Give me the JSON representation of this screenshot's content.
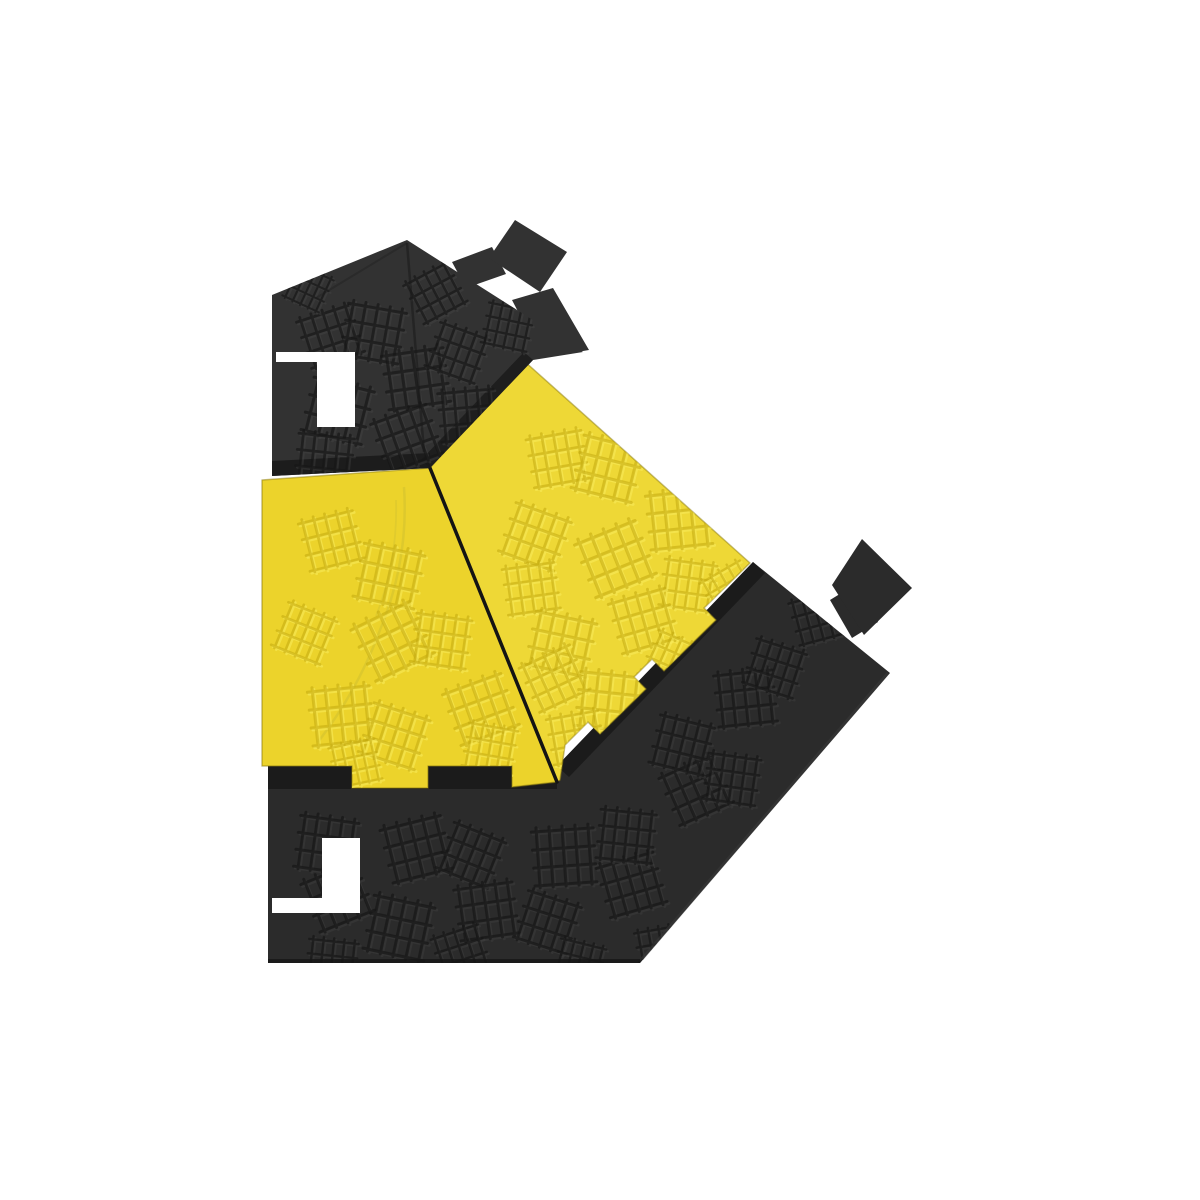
{
  "image": {
    "background_color": "#ffffff",
    "description": "Top view of a black and yellow 45-degree corner piece of a modular cable protector ramp: yellow hinged lid made of two embossed panels, black rubber base sections with puzzle-type interlocking connector tabs and slots",
    "colors": {
      "lid_yellow": "#ecd32b",
      "lid_yellow_right": "#eed836",
      "base_black": "#2b2b2b",
      "base_black_top": "#323232",
      "chamfer_black": "#191919",
      "seam": "#141414",
      "crease": "#d9c72e",
      "emboss_dark_yellow": "#c2a90f",
      "emboss_light_yellow": "#f9ec5c",
      "emboss_dark_black": "#171717",
      "emboss_light_black": "#454545"
    }
  }
}
